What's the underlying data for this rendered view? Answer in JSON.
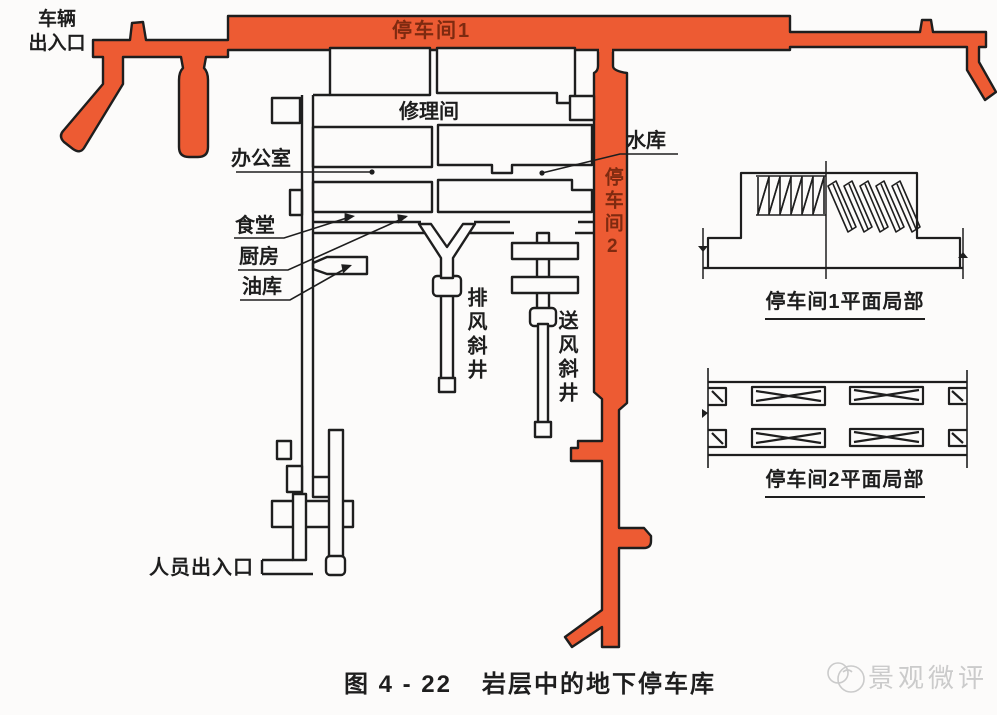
{
  "plan": {
    "vehicle_entrance_line1": "车辆",
    "vehicle_entrance_line2": "出入口",
    "parking_room1": "停车间1",
    "parking_room2": "停车间2",
    "repair_room": "修理间",
    "office": "办公室",
    "reservoir": "水库",
    "canteen": "食堂",
    "kitchen": "厨房",
    "oil_depot": "油库",
    "exhaust_shaft": "排风斜井",
    "supply_shaft": "送风斜井",
    "personnel_entrance": "人员出入口"
  },
  "details": {
    "detail1_caption": "停车间1平面局部",
    "detail2_caption": "停车间2平面局部"
  },
  "figure": {
    "number": "图 4 - 22",
    "title": "岩层中的地下停车库"
  },
  "watermark": {
    "text": "景观微评"
  },
  "colors": {
    "tunnel_fill": "#ed5b33",
    "tunnel_label": "#7e2a10",
    "line": "#1e1e1e",
    "watermark": "#cbcbcb",
    "background": "#fcfbfa"
  }
}
